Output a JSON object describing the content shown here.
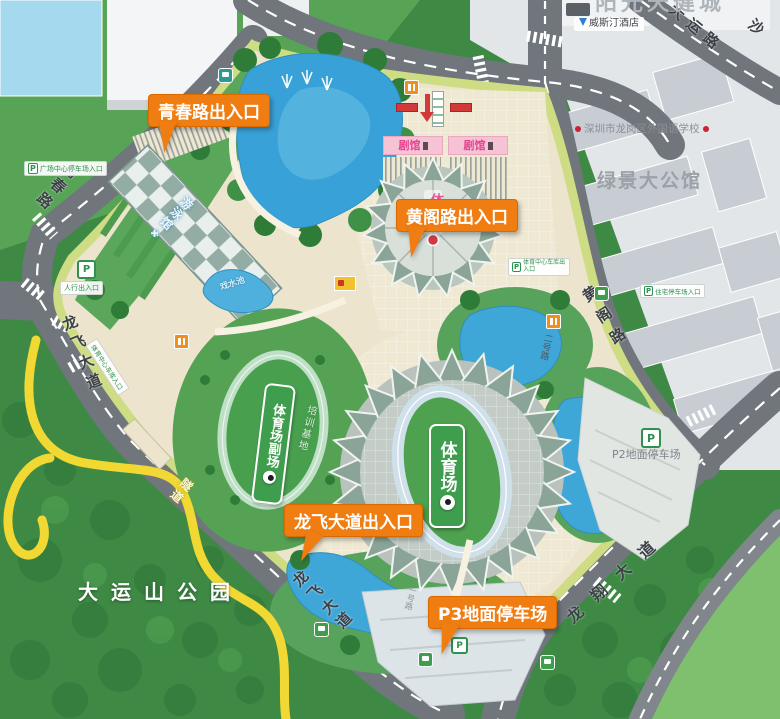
{
  "park": {
    "name": "大运山公园"
  },
  "roads": {
    "dayun": "大运路",
    "sha": "沙",
    "qingchun": "青春路",
    "longfei_upper": "龙飞大道",
    "longfei_lower": "龙飞大道",
    "huangge": "黄阁路",
    "longxiang": "龙翔大道",
    "erhao": "二号路",
    "yihao": "一号路",
    "tunnel": "隧道"
  },
  "gates": {
    "qingchun": "青春路出入口",
    "huangge": "黄阁路出入口",
    "longfei": "龙飞大道出入口"
  },
  "venues": {
    "stadium": "体育场",
    "stadium_sub": "体育场副场",
    "training_base": "培训基地",
    "gym": "体育馆",
    "natatorium": "游泳馆",
    "theater_left": "剧馆",
    "theater_right": "剧馆",
    "splash_pool": "戏水池"
  },
  "parking": {
    "p2": "P2地面停车场",
    "p3": "P3地面停车场",
    "badge_letter": "P",
    "plaza_sign": "广场中心停车场入口",
    "west_sign": "人行出入口",
    "roadside_sign": "体育中心车库入口",
    "huangge_sign": "体育中心车库出入口",
    "estate_sign": "住宅停车场入口"
  },
  "landmarks": {
    "tianjian_city": "阳光天健城",
    "westin_hotel": "威斯汀酒店",
    "school": "深圳市龙岗区外国语学校",
    "mansion": "绿景大公馆"
  },
  "icons": {
    "snowflake": "✚"
  },
  "colors": {
    "callout_orange": "#ef7d12",
    "road_grey": "#70767c",
    "water_blue": "#3fa6d8",
    "forest_green": "#3e8a45",
    "field_green": "#43a04b",
    "park_cream": "#ece4cc",
    "edge_yellow_green": "#cedc84",
    "tunnel_yellow": "#f2d832"
  }
}
